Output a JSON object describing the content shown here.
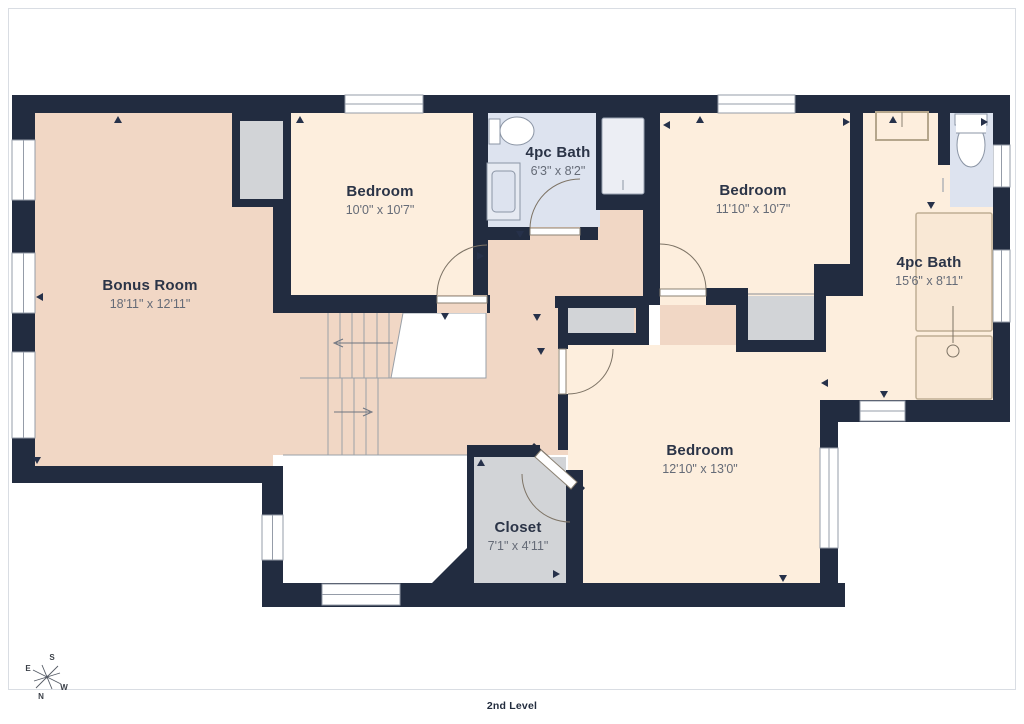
{
  "floor_label": "2nd Level",
  "rooms": [
    {
      "id": "bonus-room",
      "name": "Bonus Room",
      "dims": "18'11\" x 12'11\""
    },
    {
      "id": "bedroom-top-left",
      "name": "Bedroom",
      "dims": "10'0\" x 10'7\""
    },
    {
      "id": "bath-top",
      "name": "4pc Bath",
      "dims": "6'3\" x 8'2\""
    },
    {
      "id": "bedroom-top-right",
      "name": "Bedroom",
      "dims": "11'10\" x 10'7\""
    },
    {
      "id": "bath-right",
      "name": "4pc Bath",
      "dims": "15'6\" x 8'11\""
    },
    {
      "id": "bedroom-bottom",
      "name": "Bedroom",
      "dims": "12'10\" x 13'0\""
    },
    {
      "id": "closet",
      "name": "Closet",
      "dims": "7'1\" x 4'11\""
    }
  ],
  "compass": {
    "s": "S",
    "e": "E",
    "w": "W",
    "n": "N"
  },
  "icons": {
    "compass": "compass-rose-icon",
    "stairs": "stairs-icon"
  },
  "colors": {
    "wall": "#222c40",
    "room_warm": "#f1d7c5",
    "room_light": "#fdeedd",
    "bath_blue": "#dde3ef",
    "closet_gray": "#d2d4d7",
    "tub_stroke": "#bfae94",
    "label_text": "#2b3447",
    "dim_text": "#656b77"
  }
}
